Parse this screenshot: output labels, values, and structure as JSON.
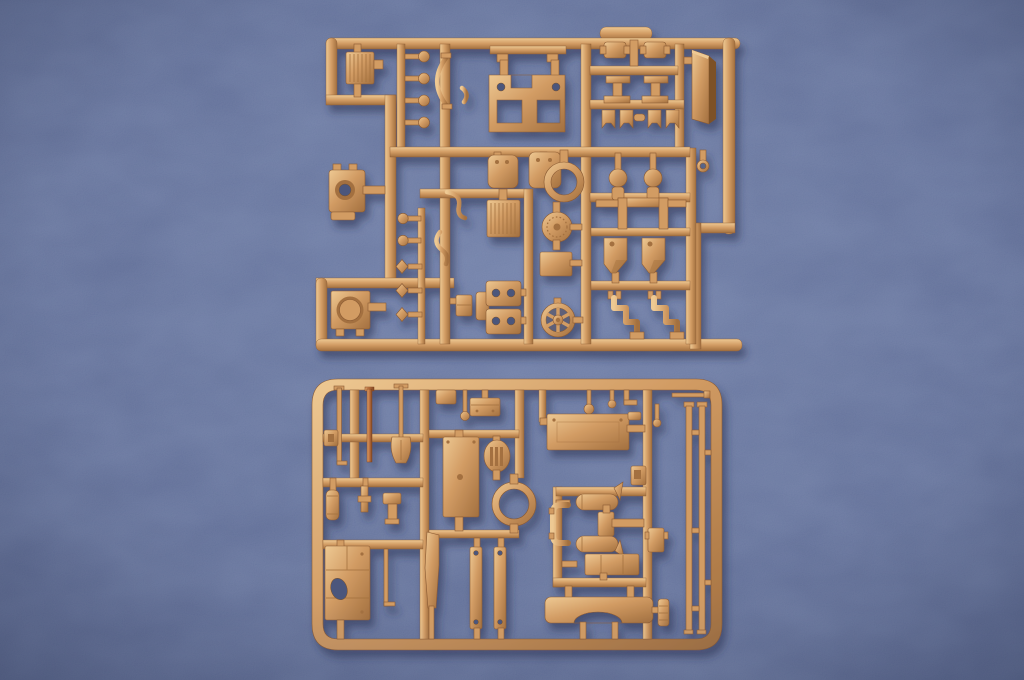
{
  "scene": {
    "type": "photograph",
    "description": "Two tan injection-molded plastic model-kit sprues (parts frames) laid on a blue fabric-textured surface, lit softly from the upper left",
    "subject": "scale model kit sprue trees with unassembled detail parts",
    "background_surface": "blue textured mat",
    "text_visible": "none"
  },
  "colors": {
    "bg_center": "#6b7aa4",
    "bg_mid": "#5c6a94",
    "bg_edge": "#4c587e",
    "shadow": "#2c3656",
    "plastic": "#d29c64",
    "plastic_light": "#eec993",
    "plastic_dark": "#a3703f",
    "plastic_deep": "#7d5128",
    "plastic_edge": "#8a5a33",
    "hole": "#4c577c",
    "copper": "#bd7240",
    "copper_light": "#e0a269",
    "copper_dark": "#7e4420"
  },
  "objects": {
    "sprue_upper": {
      "position": "top half, offset right",
      "shape": "irregular stepped rectangular frame",
      "parts": [
        "ribbed radiator block",
        "round-head pins",
        "curved tow-cable bow",
        "bridge plate with square openings",
        "top bar with tabs",
        "mounting bracket pairs",
        "tall armor slab",
        "small clamp fittings",
        "rounded tank boxes",
        "large ring",
        "pear-shaped pump bottles",
        "small eyelet",
        "U-channel bracket",
        "gun mantlet block",
        "wire hooks",
        "ribbed grille plate",
        "perforated fan disc",
        "rectangular plate",
        "chamfered ammo-box blocks",
        "Z-shaped pipe brackets",
        "diamond-head pins",
        "hatch plate with round opening",
        "two-hole plates",
        "spoked wheel",
        "small stepped boxes"
      ]
    },
    "sprue_lower": {
      "position": "bottom half, centered",
      "shape": "rounded rectangular frame",
      "parts": [
        "thin rod",
        "copper-colored cleaning rod",
        "shovel",
        "small cylinder",
        "periscope rod",
        "jack block",
        "roof plate with hatch cutout",
        "hooked rod",
        "small box with ball pin",
        "tool box",
        "tall hull plate",
        "oval slotted grille",
        "turret ring",
        "tapered fender blade",
        "two drilled flat bars",
        "wide roof panel",
        "ball-head pins",
        "twin-cylinder frame assembly",
        "stowage bin",
        "bracket with notch",
        "curved wheel-arch fender",
        "ribbed canister",
        "two long rail rods"
      ]
    }
  }
}
